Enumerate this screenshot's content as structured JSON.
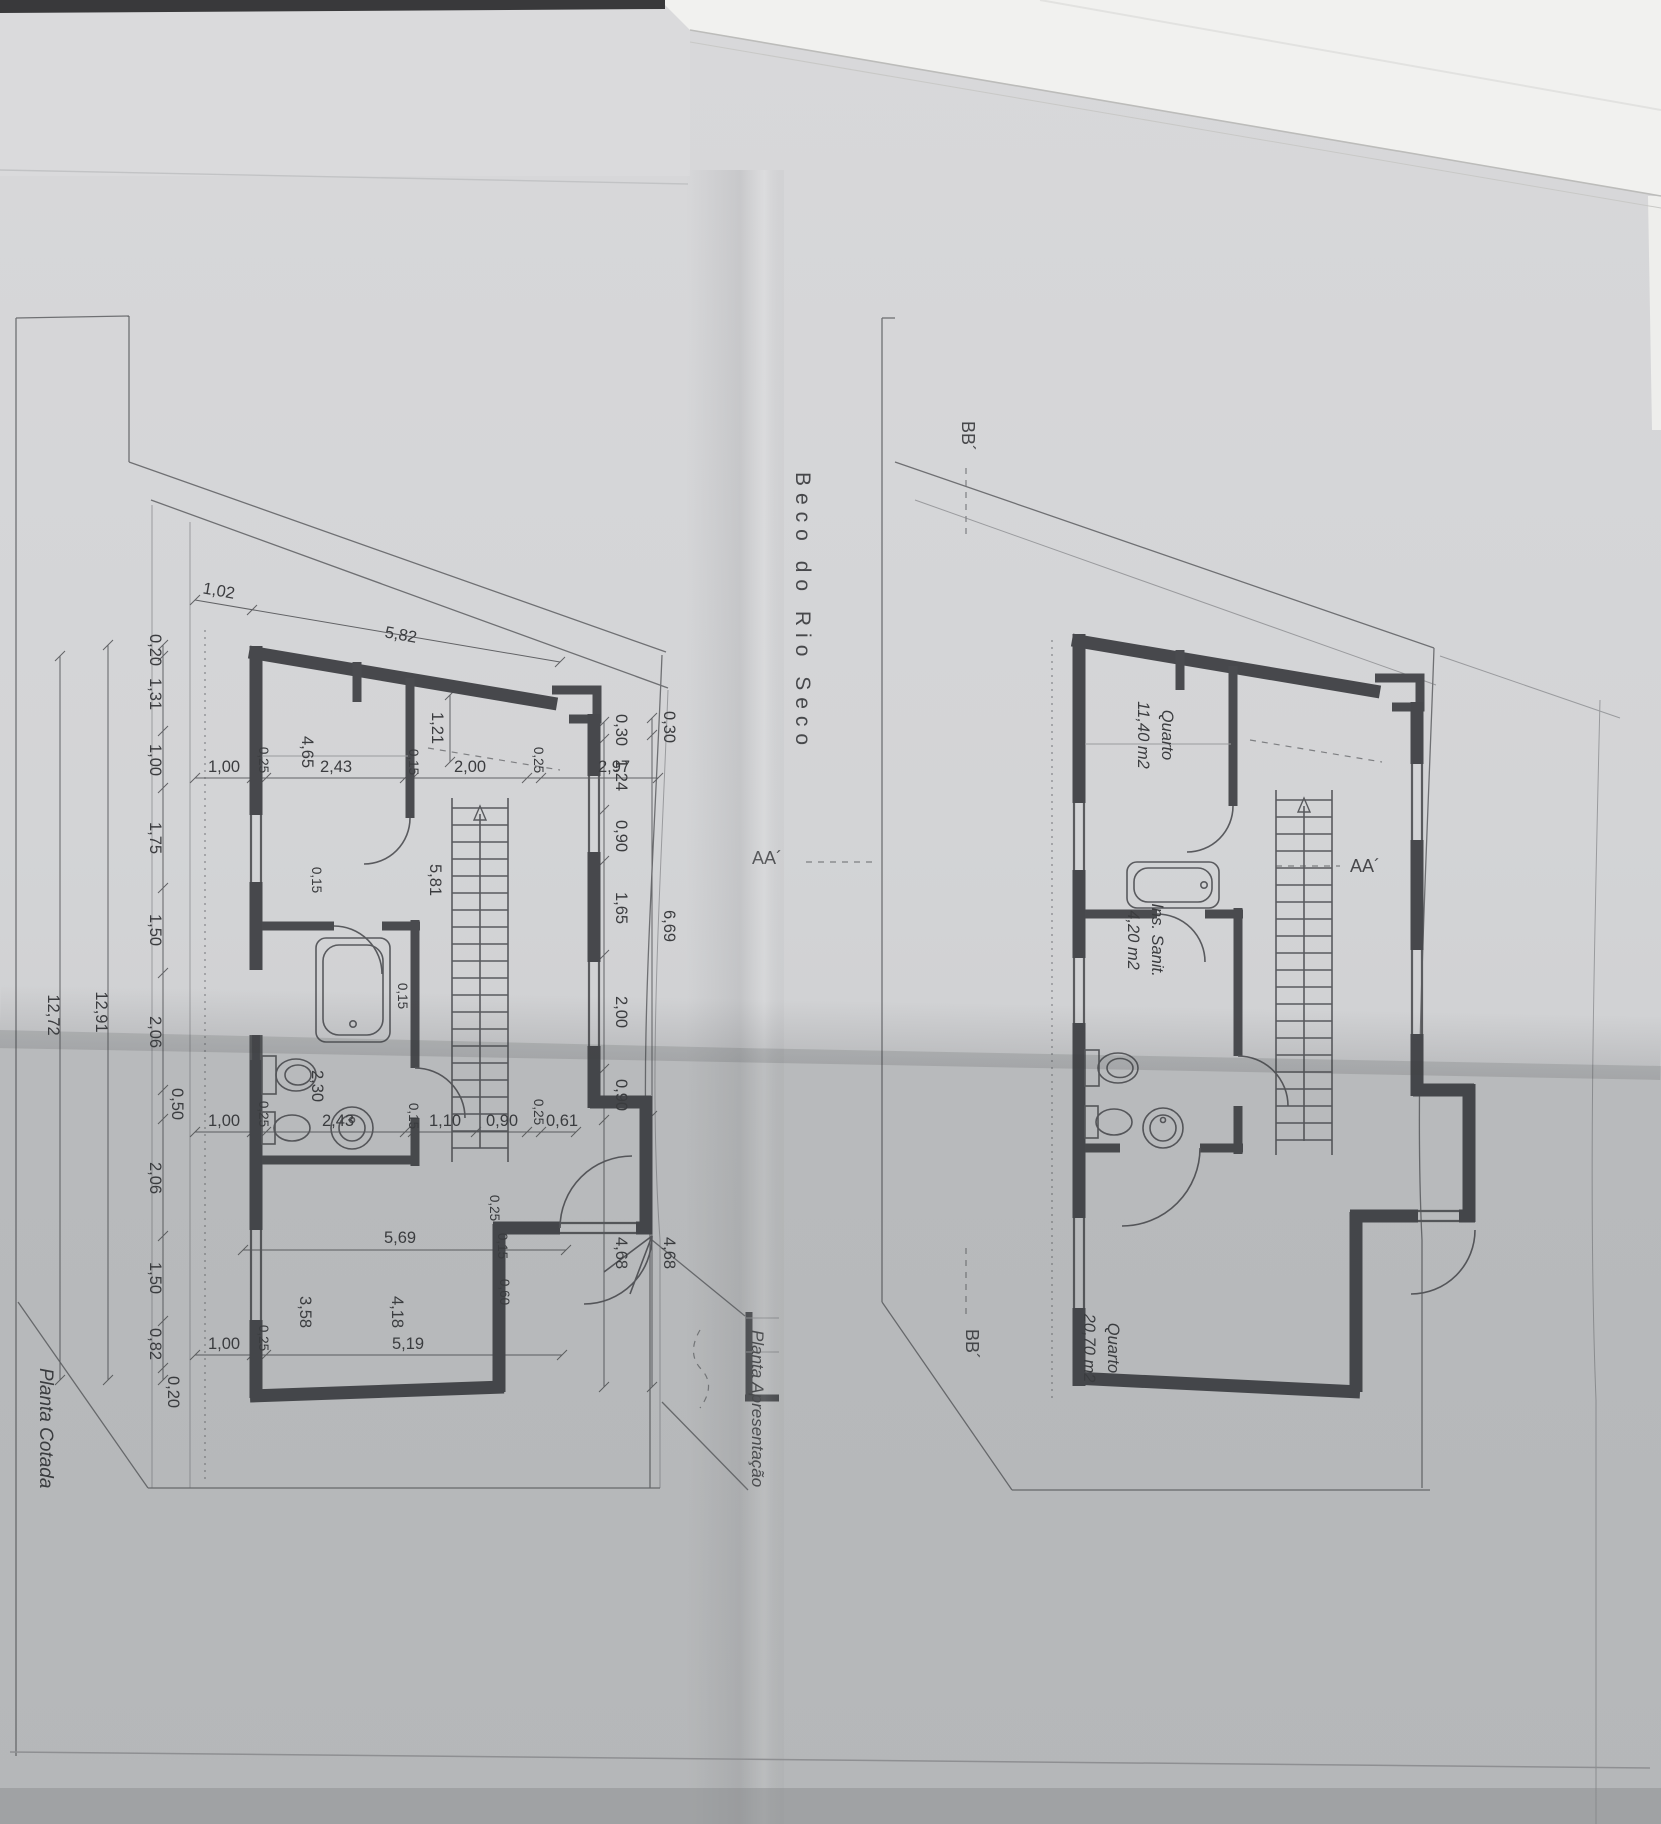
{
  "sheet": {
    "street_name": "Beco do Rio Seco",
    "markers": {
      "bb_top": "BB´",
      "bb_bottom": "BB´",
      "aa_left": "AA´",
      "aa_right": "AA´"
    }
  },
  "left_plan": {
    "title": "Planta Cotada",
    "top_dims": [
      "1,02",
      "5,82"
    ],
    "left_chain": [
      "0,20",
      "1,31",
      "1,00",
      "1,75",
      "1,50",
      "2,06",
      "0,50",
      "2,06",
      "1,50",
      "0,82",
      "0,20"
    ],
    "left_totals": [
      "12,91",
      "12,72"
    ],
    "upper_line": [
      "1,00",
      "0,25",
      "4,65",
      "2,43",
      "0,15",
      "2,00",
      "0,25",
      "2,97"
    ],
    "mid_line": [
      "1,00",
      "0,25",
      "2,30",
      "2,43",
      "0,15",
      "1,10",
      "0,90",
      "0,25",
      "0,61"
    ],
    "right_chain": [
      "0,30",
      "1,24",
      "0,90",
      "1,65",
      "2,00",
      "0,90",
      "4,68"
    ],
    "right_outer": [
      "0,30",
      "6,69",
      "4,68"
    ],
    "interior": [
      "1,21",
      "5,81",
      "0,15",
      "0,15",
      "0,15",
      "0,60"
    ],
    "bottom_line": [
      "1,00",
      "0,25",
      "5,19"
    ],
    "lower_dims": [
      "5,69",
      "3,58",
      "4,18",
      "0,25"
    ]
  },
  "right_plan": {
    "title": "Planta Apresentação",
    "rooms": [
      {
        "name": "Quarto",
        "area": "11,40 m2"
      },
      {
        "name": "Ins. Sanit.",
        "area": "4,20 m2"
      },
      {
        "name": "Quarto",
        "area": "20,70 m2"
      }
    ]
  }
}
